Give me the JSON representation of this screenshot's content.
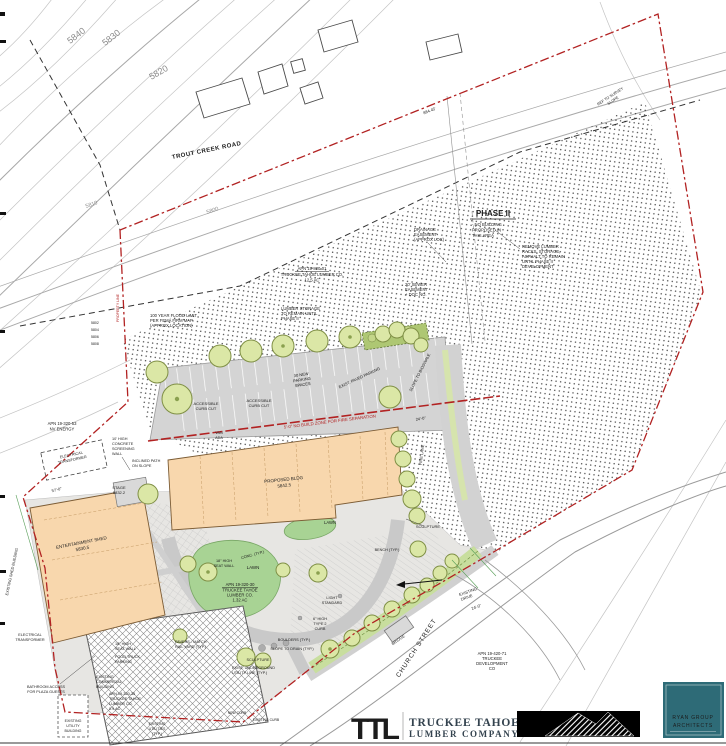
{
  "contours": {
    "c5840": "5840",
    "c5830": "5830",
    "c5820": "5820",
    "c5810": "5810",
    "c5800": "5800",
    "minor": [
      "5802",
      "5804",
      "5806",
      "5808"
    ]
  },
  "roads": {
    "trout_creek": "TROUT CREEK ROAD",
    "church_street": "CHURCH STREET",
    "bridge": "BRIDGE",
    "existing_drive_lines": [
      "EXISTING",
      "DRIVE"
    ],
    "drive_dim": "24'-0\"",
    "parking_dim": "24'-0\"",
    "fire_lane": "FIRE LANE",
    "slope_ref_lines": [
      "REF TO SURVEY",
      "SLOPE"
    ]
  },
  "phase2": {
    "title": "PHASE II",
    "note_lines": [
      "- NO BUILDING",
      "PROPOSED IN",
      "THIS AREA"
    ],
    "remove_lines": [
      "REMOVE LUMBER",
      "RACKS, STORAGE,",
      "ASPHALT TO REMAIN",
      "UNTIL PHASE II",
      "DEVELOPMENT"
    ],
    "drainage_lines": [
      "DRAINAGE",
      "EASEMENT",
      "(APPROX LOC)"
    ],
    "sewer_lines": [
      "20' SEWER",
      "EASEMENT",
      "+ DOC NO."
    ],
    "apn_lines": [
      "APN 19-820-01",
      "TRUCKEE TAHOE LUMBER CO.",
      "12.5 AC"
    ],
    "storage_lines": [
      "LUMBER STORAGE",
      "TO REMAIN UNTIL",
      "PHASE II"
    ],
    "flood_lines": [
      "100 YEAR FLOOD LIMIT",
      "PER FEMA FIRM MAP",
      "(APPROX LOCATION)"
    ],
    "boundary_dim": "884.45'",
    "property_line": "PROPERTY LINE"
  },
  "parking": {
    "curb_cut_lines": [
      "ACCESSIBLE",
      "CURB CUT"
    ],
    "van_lines": [
      "VAN",
      "ADA"
    ],
    "spaces_lines": [
      "30 NEW",
      "PARKING",
      "SPACES"
    ],
    "paved": "EXIST. PAVED PARKING",
    "bioswale": "SLOPE TO BIOSWALE",
    "no_build": "5'-0\" NO BUILD ZONE FOR FIRE SEPARATION"
  },
  "west": {
    "apn_lines": [
      "APN 19-320-53",
      "NV ENERGY"
    ],
    "transformer_lines": [
      "ELECTRICAL",
      "TRANSFORMER"
    ],
    "wall_lines": [
      "10' HIGH",
      "CONCRETE",
      "SCREENING",
      "WALL"
    ],
    "path_lines": [
      "INCLINED PATH",
      "ON SLOPE"
    ],
    "stage_lines": [
      "STAGE",
      "5832.2"
    ],
    "dim": "57'-0\"",
    "shed_lines": [
      "ENTERTAINMENT SHED",
      "5830.5"
    ],
    "existing_shed": "EXISTING SHED BUILDING"
  },
  "building": {
    "label_lines": [
      "PROPOSED BLDG",
      "5842.5"
    ]
  },
  "plaza": {
    "seat_wall_lines": [
      "18\" HIGH",
      "SEAT WALL"
    ],
    "conc": "CONC. (TYP.)",
    "lawn": "LAWN",
    "apn_lines": [
      "APN 19-320-30",
      "TRUCKEE TAHOE",
      "LUMBER CO.",
      "1.32 AC"
    ],
    "light_lines": [
      "LIGHT",
      "STANDARD"
    ],
    "curb_lines": [
      "6\" HIGH",
      "TYPE 2",
      "CURB"
    ],
    "boulders": "BOULDERS (TYP.)",
    "slope_drain": "SLOPE TO DRAIN (TYP.)",
    "sculpture": "SCULPTURE",
    "utility_lines": [
      "EXIST. UNDERGROUND",
      "UTILITY LINE (TYP.)"
    ],
    "bench": "BENCH (TYP.)"
  },
  "south": {
    "seat_wall_lines": [
      "18\" HIGH",
      "SEAT WALL"
    ],
    "food_truck_lines": [
      "FOOD TRUCK",
      "PARKING"
    ],
    "commercial_lines": [
      "EXISTING",
      "COMMERCIAL",
      "BUILDING"
    ],
    "apn_lines": [
      "APN 19-320-35",
      "TRUCKEE TAHOE",
      "LUMBER CO.",
      "0.9 AC"
    ],
    "bathroom_lines": [
      "BATHROOM ACCESS",
      "FOR PLAZA GUESTS"
    ],
    "transformer_lines": [
      "ELECTRICAL",
      "TRANSFORMER"
    ],
    "utility_bldg_lines": [
      "EXISTING",
      "UTILITY",
      "BUILDING"
    ],
    "utilities_lines": [
      "EXISTING",
      "UTILITIES",
      "(TYP.)"
    ],
    "pavers_lines": [
      "PAVERS - MATCH",
      "RAIL YARD (TYP.)"
    ],
    "new_curb": "NEW CURB",
    "existing_curb": "EXISTING CURB",
    "apn_dev_lines": [
      "APN 19-420-71",
      "TRUCKEE",
      "DEVELOPMENT",
      "CO"
    ]
  },
  "footer": {
    "logo_mark": "TTL",
    "company_line1": "TRUCKEE TAHOE",
    "company_line2": "LUMBER COMPANY",
    "architect_line1": "RYAN GROUP",
    "architect_line2": "ARCHITECTS"
  },
  "colors": {
    "boundary_red": "#b22222",
    "building_fill": "#f8d7ad",
    "tree_fill": "#dbe7a6",
    "lawn_fill": "#a8d394",
    "stipple_dot": "#1a1a1a",
    "teal_brand": "#2e6b77",
    "logo_gold": "#d7a51e",
    "navy_text": "#33424e"
  }
}
